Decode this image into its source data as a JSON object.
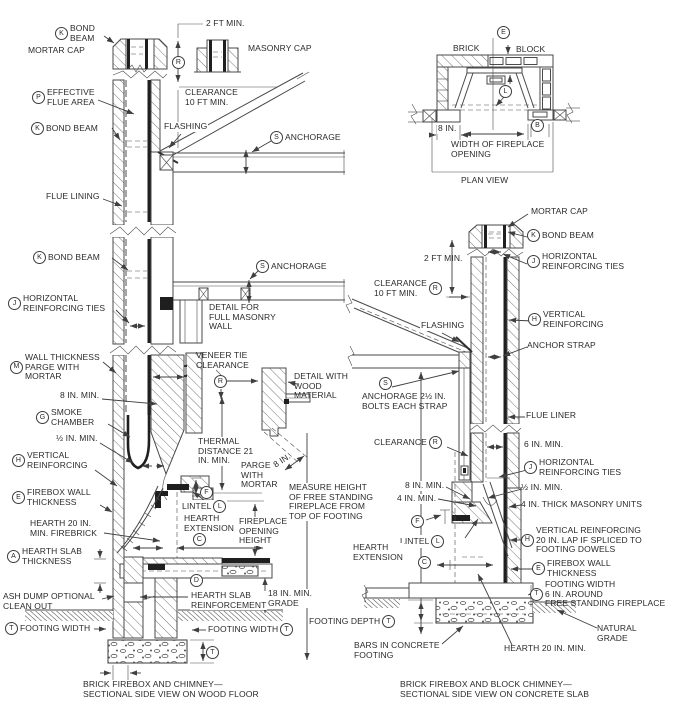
{
  "L": {
    "cap_bond_beam": {
      "key": "K",
      "text": "BOND\nBEAM"
    },
    "mortar_cap": "MORTAR CAP",
    "two_ft": "2 FT MIN.",
    "masonry_cap": "MASONRY CAP",
    "r1": "R",
    "clearance10": "CLEARANCE\n10 FT MIN.",
    "flue_area": {
      "key": "P",
      "text": "EFFECTIVE\nFLUE AREA"
    },
    "bond_beam1": {
      "key": "K",
      "text": "BOND BEAM"
    },
    "flashing": "FLASHING",
    "anchorage1": {
      "key": "S",
      "text": "ANCHORAGE"
    },
    "flue_lining": "FLUE LINING",
    "bond_beam2": {
      "key": "K",
      "text": "BOND BEAM"
    },
    "anchorage2": {
      "key": "S",
      "text": "ANCHORAGE"
    },
    "horiz_ties": {
      "key": "J",
      "text": "HORIZONTAL\nREINFORCING TIES"
    },
    "detail_masonry": "DETAIL FOR\nFULL MASONRY\nWALL",
    "wall_thick": {
      "key": "M",
      "text": "WALL THICKNESS\nPARGE WITH\nMORTAR"
    },
    "veneer_tie": "VENEER TIE\nCLEARANCE",
    "r2": "R",
    "detail_wood": "DETAIL WITH\nWOOD\nMATERIAL",
    "eight_min": "8 IN. MIN.",
    "smoke": {
      "key": "G",
      "text": "SMOKE\nCHAMBER"
    },
    "half_min": "½ IN. MIN.",
    "vert_reinf": {
      "key": "H",
      "text": "VERTICAL\nREINFORCING"
    },
    "thermal": "THERMAL\nDISTANCE 21\nIN. MIN.",
    "parge": "PARGE\nWITH\nMORTAR",
    "eight": "8 IN.",
    "firebox_wall": {
      "key": "E",
      "text": "FIREBOX WALL\nTHICKNESS"
    },
    "f": "F",
    "lintel": "LINTEL",
    "l": "L",
    "hearth20": "HEARTH 20 IN.\nMIN. FIREBRICK",
    "hearth_ext": "HEARTH\nEXTENSION",
    "c": "C",
    "open_height": "FIREPLACE\nOPENING\nHEIGHT",
    "slab": {
      "key": "A",
      "text": "HEARTH SLAB\nTHICKNESS"
    },
    "d": "D",
    "ash": "ASH DUMP OPTIONAL\nCLEAN OUT",
    "slab_reinf": "HEARTH SLAB\nREINFORCEMENT",
    "grade18": "18 IN. MIN.\nGRADE",
    "fw_l": {
      "key": "T",
      "text": "FOOTING WIDTH"
    },
    "fw_r": "FOOTING WIDTH",
    "t_r": "T",
    "t2": "T",
    "caption": "BRICK FIREBOX AND CHIMNEY—\nSECTIONAL SIDE VIEW ON WOOD FLOOR"
  },
  "M": {
    "measure": "MEASURE HEIGHT\nOF FREE STANDING\nFIREPLACE FROM\nTOP OF FOOTING",
    "depth": "FOOTING DEPTH",
    "t": "T"
  },
  "P": {
    "brick": "BRICK",
    "e": "E",
    "block": "BLOCK",
    "l": "L",
    "eight": "8 IN.",
    "b": "B",
    "width": "WIDTH OF FIREPLACE\nOPENING",
    "title": "PLAN VIEW"
  },
  "R": {
    "mortar_cap": "MORTAR CAP",
    "bond_beam": {
      "key": "K",
      "text": "BOND BEAM"
    },
    "two_ft": "2 FT MIN.",
    "ties_top": {
      "key": "J",
      "text": "HORIZONTAL\nREINFORCING TIES"
    },
    "clearance10": "CLEARANCE\n10 FT MIN.",
    "r1": "R",
    "flashing": "FLASHING",
    "vert_reinf": {
      "key": "H",
      "text": "VERTICAL\nREINFORCING"
    },
    "anchor_strap": "ANCHOR STRAP",
    "s": "S",
    "anchorage": "ANCHORAGE 2½ IN.\nBOLTS EACH STRAP",
    "flue_liner": "FLUE LINER",
    "clearance": "CLEARANCE",
    "r2": "R",
    "six_min": "6 IN. MIN.",
    "ties_low": {
      "key": "J",
      "text": "HORIZONTAL\nREINFORCING TIES"
    },
    "eight_min": "8 IN. MIN.",
    "half_min": "½ IN. MIN.",
    "four_min": "4 IN. MIN.",
    "four_units": "4 IN. THICK MASONRY UNITS",
    "f": "F",
    "lintel": "LINTEL",
    "l": "L",
    "vert_lap": {
      "key": "H",
      "text": "VERTICAL REINFORCING\n20 IN. LAP IF SPLICED TO\nFOOTING DOWELS"
    },
    "hearth_ext": "HEARTH\nEXTENSION",
    "c": "C",
    "firebox_wall": {
      "key": "E",
      "text": "FIREBOX WALL\nTHICKNESS"
    },
    "footing_width": {
      "key": "T",
      "text": "FOOTING WIDTH\n6 IN. AROUND\nFREE STANDING FIREPLACE"
    },
    "natural_grade": "NATURAL\nGRADE",
    "bars": "BARS IN CONCRETE\nFOOTING",
    "hearth20": "HEARTH 20 IN. MIN.",
    "caption": "BRICK FIREBOX AND BLOCK CHIMNEY—\nSECTIONAL SIDE VIEW ON CONCRETE SLAB"
  }
}
